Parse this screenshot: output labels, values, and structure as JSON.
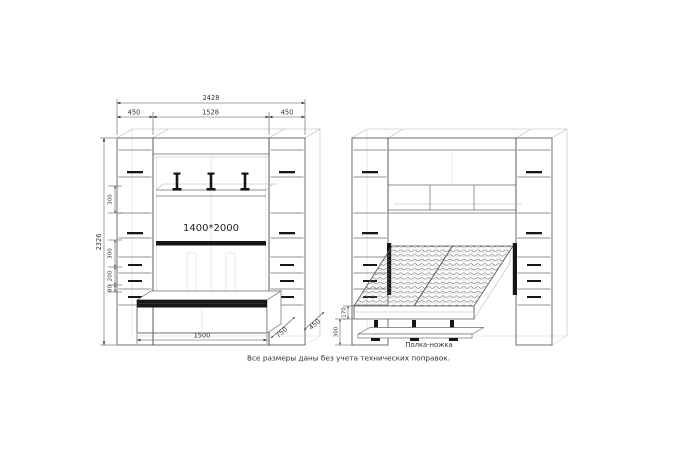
{
  "caption": "Все размеры даны без учета технических поправок.",
  "closed_view": {
    "mattress_label": "1400*2000",
    "dims": {
      "total_width": "2428",
      "left_side_width": "450",
      "center_width": "1528",
      "right_side_width": "450",
      "total_height": "2326",
      "upper_section": "300",
      "middle_section": "300",
      "drawer_section": "200",
      "plinth_height": "80",
      "bench_width": "1500",
      "bench_depth": "750",
      "side_depth": "450"
    }
  },
  "open_view": {
    "leg_shelf_label": "Полка-ножка",
    "dims": {
      "frame_height": "170",
      "leg_height": "300"
    }
  },
  "colors": {
    "ink": "#565656",
    "dark_fill": "#161616",
    "dim_text": "#333333"
  }
}
